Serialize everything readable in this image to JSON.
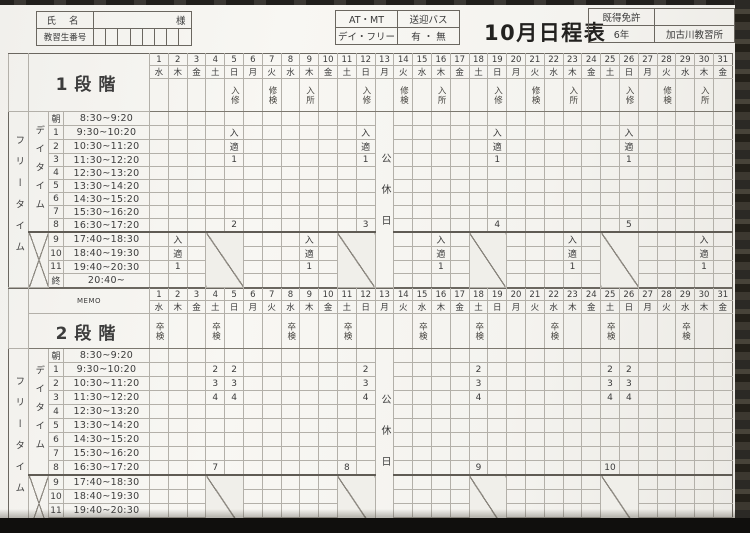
{
  "header": {
    "name_label": "氏 名",
    "name_suffix": "様",
    "student_no_label": "教習生番号",
    "transmission": "AT・MT",
    "shuttle_label": "送迎バス",
    "day_free_label": "デイ・フリー",
    "shuttle_options": "有 ・ 無",
    "title": "10月日程表",
    "license_label": "既得免許",
    "license_value": "",
    "license_years": "6年",
    "school": "加古川教習所"
  },
  "labels": {
    "free_time": "フリータイム",
    "day_time": "デイタイム",
    "memo": "MEMO",
    "holiday": "公休日"
  },
  "calendar": {
    "dates": [
      "1",
      "2",
      "3",
      "4",
      "5",
      "6",
      "7",
      "8",
      "9",
      "10",
      "11",
      "12",
      "13",
      "14",
      "15",
      "16",
      "17",
      "18",
      "19",
      "20",
      "21",
      "22",
      "23",
      "24",
      "25",
      "26",
      "27",
      "28",
      "29",
      "30",
      "31"
    ],
    "days": [
      "水",
      "木",
      "金",
      "土",
      "日",
      "月",
      "火",
      "水",
      "木",
      "金",
      "土",
      "日",
      "月",
      "火",
      "水",
      "木",
      "金",
      "土",
      "日",
      "月",
      "火",
      "水",
      "木",
      "金",
      "土",
      "日",
      "月",
      "火",
      "水",
      "木",
      "金"
    ]
  },
  "periods": [
    {
      "no": "朝",
      "time": "8:30~9:20"
    },
    {
      "no": "1",
      "time": "9:30~10:20"
    },
    {
      "no": "2",
      "time": "10:30~11:20"
    },
    {
      "no": "3",
      "time": "11:30~12:20"
    },
    {
      "no": "4",
      "time": "12:30~13:20"
    },
    {
      "no": "5",
      "time": "13:30~14:20"
    },
    {
      "no": "6",
      "time": "14:30~15:20"
    },
    {
      "no": "7",
      "time": "15:30~16:20"
    },
    {
      "no": "8",
      "time": "16:30~17:20"
    },
    {
      "no": "9",
      "time": "17:40~18:30"
    },
    {
      "no": "10",
      "time": "18:40~19:30"
    },
    {
      "no": "11",
      "time": "19:40~20:30"
    },
    {
      "no": "終",
      "time": "20:40~"
    }
  ],
  "holiday_col": 13,
  "night_diagonal_pairs": [
    [
      4,
      5
    ],
    [
      11,
      12
    ],
    [
      18,
      19
    ],
    [
      25,
      26
    ]
  ],
  "stage1": {
    "label": "1段階",
    "special_row": {
      "5": "入修",
      "7": "修検",
      "9": "入所",
      "12": "入修",
      "14": "修検",
      "16": "入所",
      "19": "入修",
      "21": "修検",
      "23": "入所",
      "26": "入修",
      "28": "修検",
      "30": "入所"
    },
    "entries": {
      "1": {
        "5": "入",
        "12": "入",
        "19": "入",
        "26": "入"
      },
      "2": {
        "5": "適",
        "12": "適",
        "19": "適",
        "26": "適"
      },
      "3": {
        "5": "1",
        "12": "1",
        "19": "1",
        "26": "1"
      },
      "8": {
        "5": "2",
        "12": "3",
        "19": "4",
        "26": "5"
      },
      "9": {
        "2": "入",
        "9": "入",
        "16": "入",
        "23": "入",
        "30": "入"
      },
      "10": {
        "2": "適",
        "9": "適",
        "16": "適",
        "23": "適",
        "30": "適"
      },
      "11": {
        "2": "1",
        "9": "1",
        "16": "1",
        "23": "1",
        "30": "1"
      }
    }
  },
  "stage2": {
    "label": "2段階",
    "special_row": {
      "1": "卒検",
      "4": "卒検",
      "8": "卒検",
      "11": "卒検",
      "15": "卒検",
      "18": "卒検",
      "22": "卒検",
      "25": "卒検",
      "29": "卒検"
    },
    "entries": {
      "1": {
        "4": "2",
        "5": "2",
        "12": "2",
        "18": "2",
        "25": "2",
        "26": "2"
      },
      "2": {
        "4": "3",
        "5": "3",
        "12": "3",
        "18": "3",
        "25": "3",
        "26": "3"
      },
      "3": {
        "4": "4",
        "5": "4",
        "12": "4",
        "18": "4",
        "25": "4",
        "26": "4"
      },
      "8": {
        "4": "7",
        "11": "8",
        "18": "9",
        "25": "10"
      }
    }
  }
}
